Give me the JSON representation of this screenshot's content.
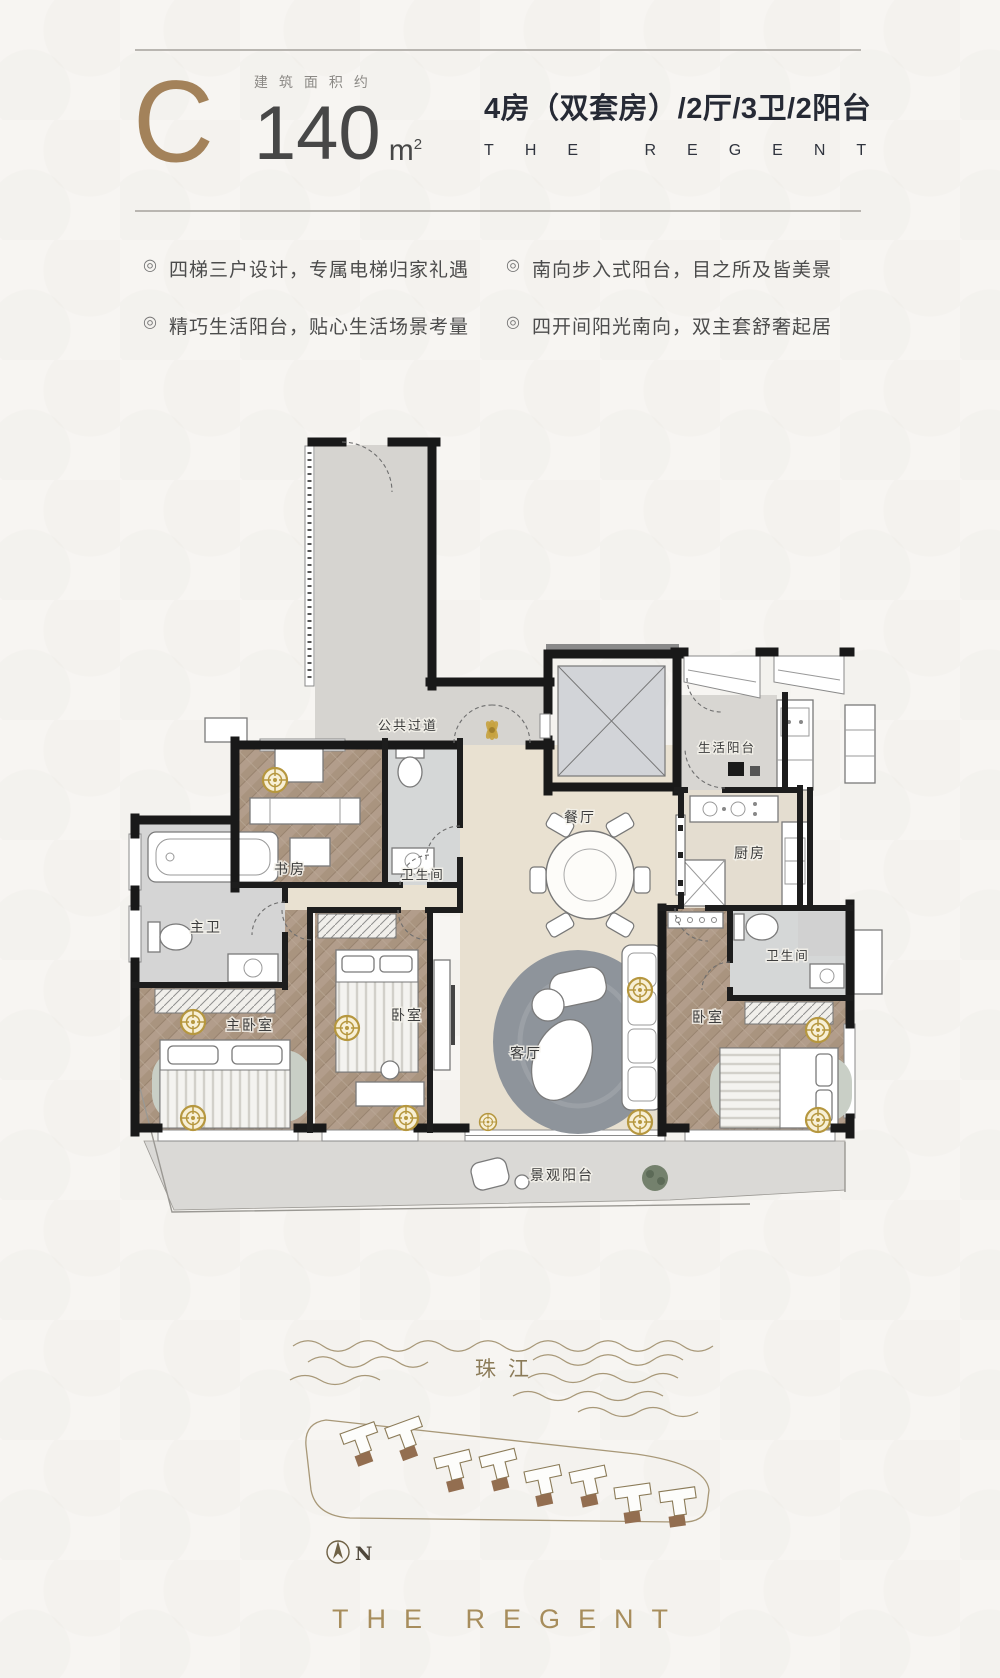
{
  "header": {
    "unit_type": "C",
    "area_label": "建筑面积约",
    "area_value": "140",
    "area_unit_base": "m",
    "area_unit_sup": "2",
    "title": "4房（双套房）/2厅/3卫/2阳台",
    "brand": "THE REGENT"
  },
  "bullet": "◎",
  "features": [
    "四梯三户设计，专属电梯归家礼遇",
    "精巧生活阳台，贴心生活场景考量",
    "南向步入式阳台，目之所及皆美景",
    "四开间阳光南向，双主套舒奢起居"
  ],
  "floorplan": {
    "rooms": [
      {
        "key": "public-corridor",
        "label": "公共过道"
      },
      {
        "key": "service-balcony",
        "label": "生活阳台"
      },
      {
        "key": "kitchen",
        "label": "厨房"
      },
      {
        "key": "dining",
        "label": "餐厅"
      },
      {
        "key": "bath-2",
        "label": "卫生间"
      },
      {
        "key": "study",
        "label": "书房"
      },
      {
        "key": "master-bath",
        "label": "主卫"
      },
      {
        "key": "master-bedroom",
        "label": "主卧室"
      },
      {
        "key": "bedroom-2",
        "label": "卧室"
      },
      {
        "key": "living",
        "label": "客厅"
      },
      {
        "key": "bedroom-3",
        "label": "卧室"
      },
      {
        "key": "bath-3",
        "label": "卫生间"
      },
      {
        "key": "view-balcony",
        "label": "景观阳台"
      }
    ]
  },
  "site_map": {
    "river_label": "珠江",
    "north_label": "N"
  },
  "footer": {
    "brand": "THE REGENT"
  },
  "colors": {
    "accent_gold": "#a3825a",
    "title_dark": "#262a35",
    "wall_black": "#191919",
    "wood_floor": "#b29d8b",
    "marble_gray": "#d6d4d0",
    "floor_beige": "#e9e1d1",
    "downlight_gold": "#b6973f"
  }
}
